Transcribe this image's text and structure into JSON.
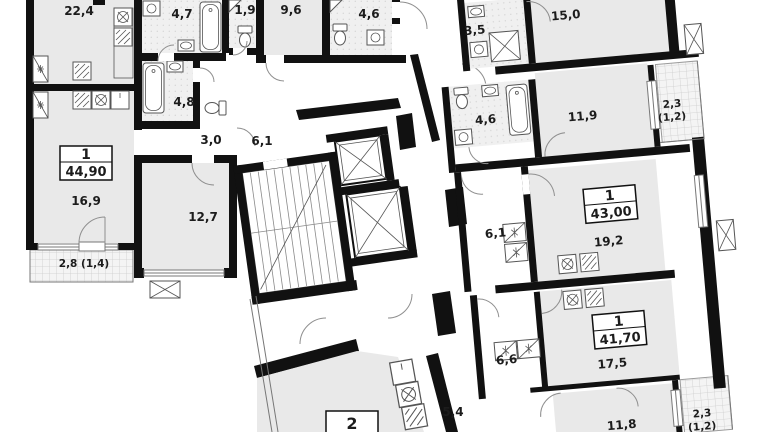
{
  "page": {
    "type": "architectural-floor-plan",
    "description": "residential building storey plan with apartment and room area labels",
    "units_visible": 4
  },
  "colors": {
    "wall": "#111111",
    "room_fill": "#e9e9e9",
    "wet_room_fill": "#f0f0f0",
    "balcony_fill": "#f4f4f4",
    "line": "#6b6b6b",
    "text": "#1c1c1c",
    "background": "#ffffff"
  },
  "units": [
    {
      "rooms": "1",
      "total_area": "44,90"
    },
    {
      "rooms": "1",
      "total_area": "43,00"
    },
    {
      "rooms": "1",
      "total_area": "41,70"
    },
    {
      "rooms": "2",
      "total_area": ""
    }
  ],
  "room_labels": [
    {
      "text": "22,4"
    },
    {
      "text": "4,7"
    },
    {
      "text": "1,9"
    },
    {
      "text": "9,6"
    },
    {
      "text": "4,6"
    },
    {
      "text": "3,5"
    },
    {
      "text": "15,0"
    },
    {
      "text": "4,8"
    },
    {
      "text": "3,0"
    },
    {
      "text": "6,1"
    },
    {
      "text": "4,6"
    },
    {
      "text": "11,9"
    },
    {
      "text": "2,3"
    },
    {
      "text": "(1,2)"
    },
    {
      "text": "16,9"
    },
    {
      "text": "12,7"
    },
    {
      "text": "2,8 (1,4)"
    },
    {
      "text": "6,1"
    },
    {
      "text": "19,2"
    },
    {
      "text": "6,6"
    },
    {
      "text": "17,5"
    },
    {
      "text": "5,4"
    },
    {
      "text": "11,8"
    },
    {
      "text": "2,3"
    },
    {
      "text": "(1,2)"
    }
  ]
}
